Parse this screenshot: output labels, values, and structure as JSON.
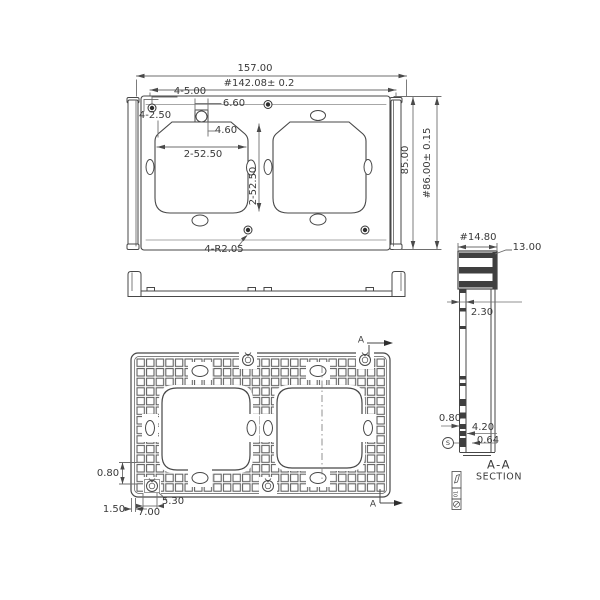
{
  "top_view": {
    "overall_width": "157.00",
    "mounting_width": "#142.08± 0.2",
    "holes_top": "4-5.00",
    "holes_corner": "4-2.50",
    "tab_width": "6.60",
    "tab_hole_offset": "4.60",
    "cutout_width": "2-52.50",
    "cutout_pitch": "2-52.50",
    "overall_height": "85.00",
    "mounting_height": "#86.00± 0.15",
    "fillet_radius": "4-R2.05"
  },
  "bottom_view": {
    "rib_thickness": "0.80",
    "wall_thickness": "1.50",
    "boss_width": "7.00",
    "boss_hole": "5.30",
    "section_label_top": "A",
    "section_label_bottom": "A"
  },
  "section_view": {
    "rail_width": "#14.80",
    "rail_height": "13.00",
    "wall_thickness": "2.30",
    "rib_thickness": "0.80",
    "boss_height": "4.20",
    "boss_gap": "0.64",
    "surface_mark": "S",
    "title": "A-A",
    "subtitle": "SECTION",
    "revision": "01"
  }
}
